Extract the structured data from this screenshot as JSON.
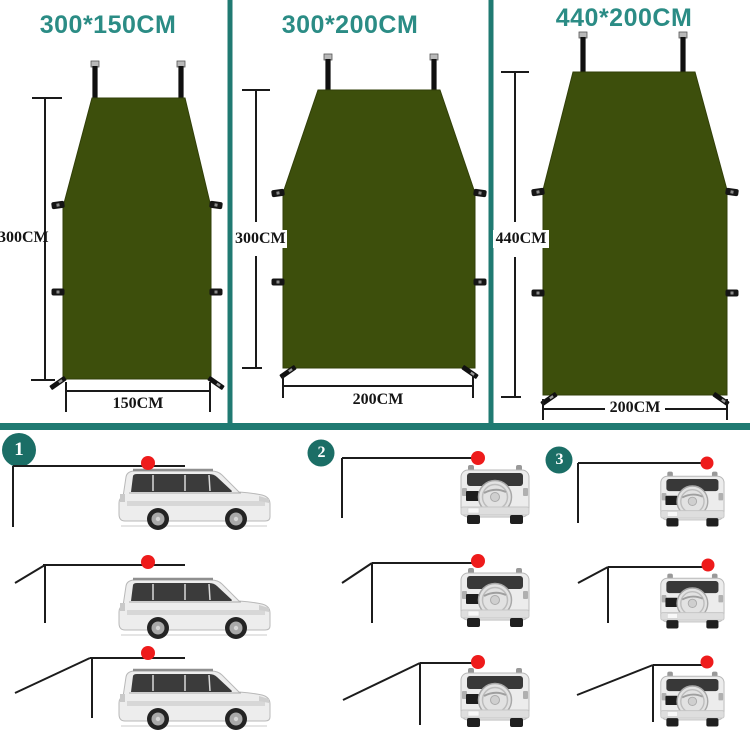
{
  "page_type": "car-awning-size-infographic",
  "colors": {
    "divider_teal": "#207a72",
    "title_teal": "#2b8c85",
    "tarp_green": "#3d4f0c",
    "badge_teal": "#1b6e66",
    "attachment_dot_red": "#ee1b1b",
    "line_black": "#1c1c1c"
  },
  "size_panels": [
    {
      "title": "300*150CM",
      "height_label": "300CM",
      "width_label": "150CM"
    },
    {
      "title": "300*200CM",
      "height_label": "300CM",
      "width_label": "200CM"
    },
    {
      "title": "440*200CM",
      "height_label": "440CM",
      "width_label": "200CM"
    }
  ],
  "setup_steps": [
    {
      "number": "1",
      "view": "suv-side-view",
      "rows": 3
    },
    {
      "number": "2",
      "view": "suv-rear-view",
      "rows": 3
    },
    {
      "number": "3",
      "view": "suv-rear-view",
      "rows": 3
    }
  ],
  "icons": {
    "attachment_point_dot": "red-circle",
    "awning_pole": "black-bar-with-cap",
    "side_tab": "black-webbing-loop",
    "corner_stake": "black-diagonal-peg"
  }
}
